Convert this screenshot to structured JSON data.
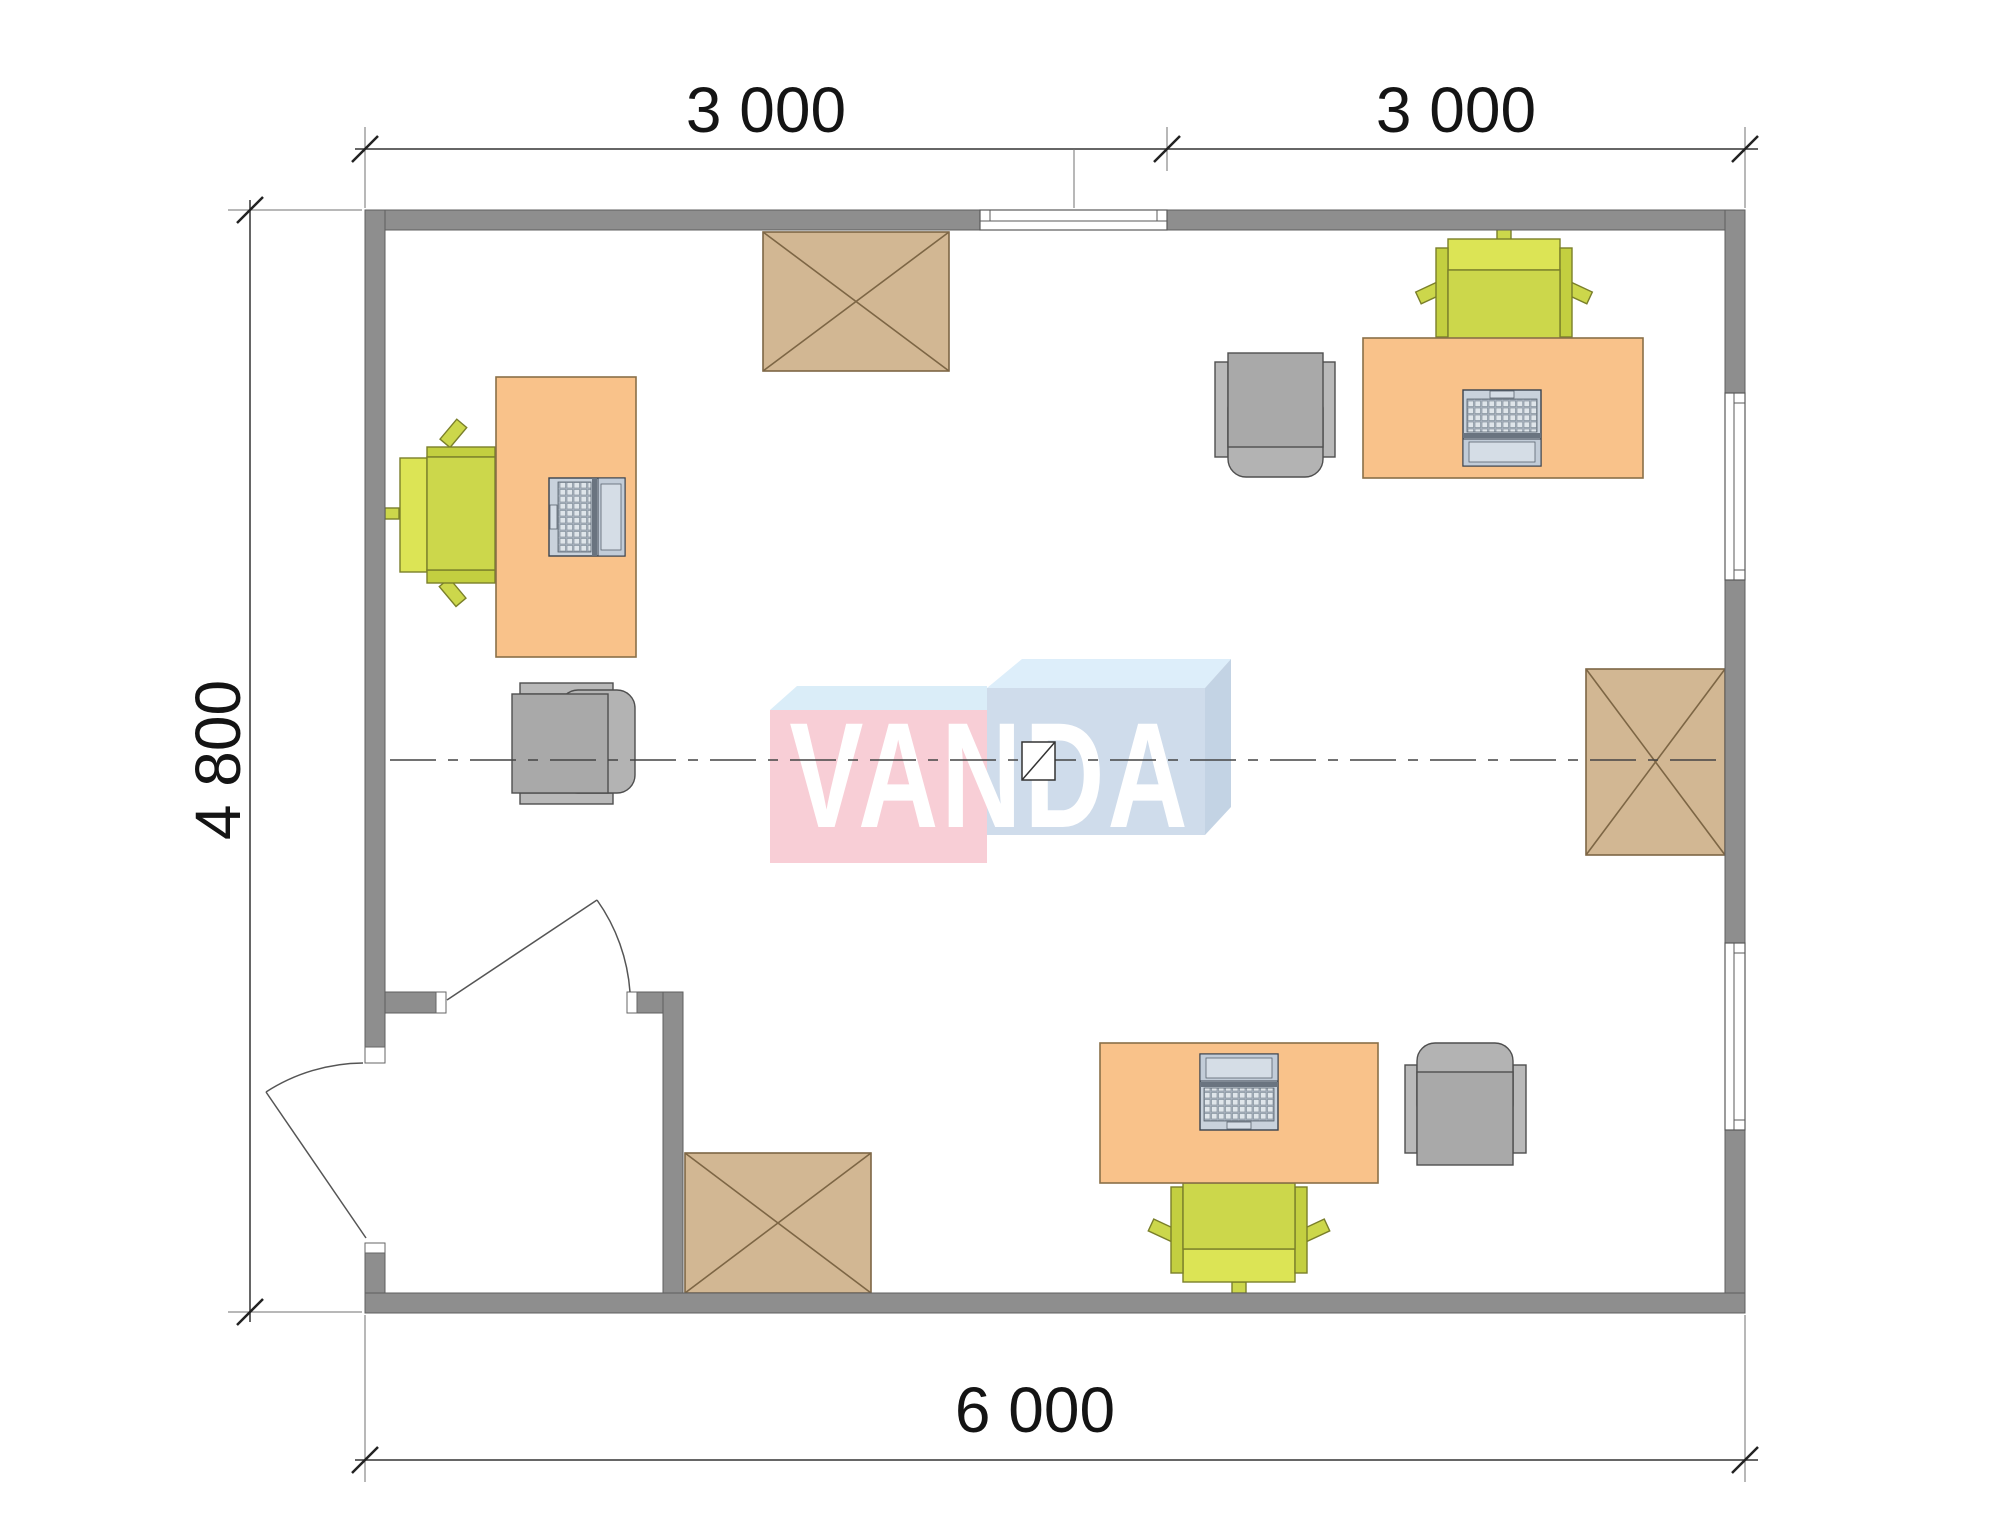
{
  "plan": {
    "title": "office-floor-plan",
    "dimension_labels": {
      "top_left": "3 000",
      "top_right": "3 000",
      "left": "4 800",
      "bottom": "6 000"
    },
    "watermark": {
      "text": "VANDA",
      "pink_face": "#f8ced6",
      "blue_face": "#cfdceb",
      "top_face": "#daedf8"
    },
    "colors": {
      "wall": "#8e8e8e",
      "desk": "#f9c28a",
      "chair_green": "#ccd74b",
      "chair_green_back": "#dce455",
      "armchair_gray": "#a9a9a9",
      "cabinet_tan": "#d2b793",
      "laptop_gray": "#c9d2dc",
      "line_dark": "#3a3a3a"
    },
    "furniture_icons": [
      "desk-icon",
      "laptop-icon",
      "office-chair-icon",
      "armchair-icon",
      "cabinet-crossed-icon",
      "window-icon",
      "door-swing-icon",
      "centerline-icon",
      "center-marker-icon"
    ]
  }
}
